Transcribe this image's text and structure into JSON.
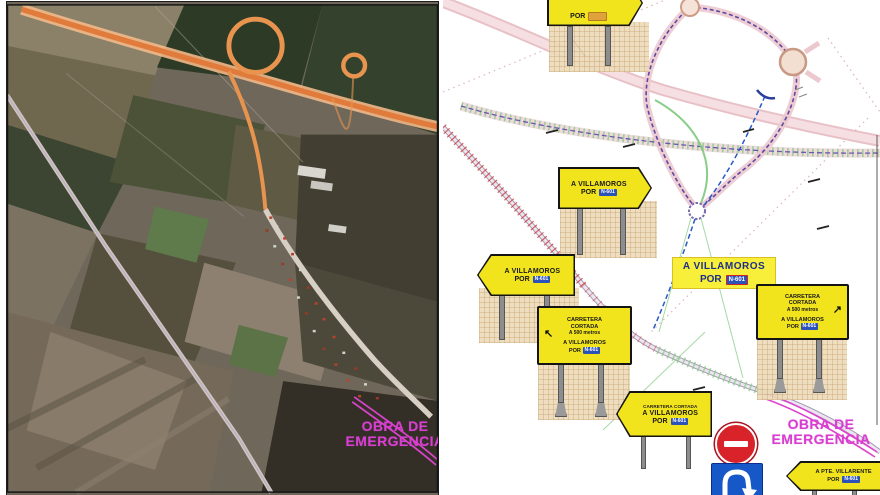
{
  "colors": {
    "sign_yellow": "#f2e41c",
    "badge_blue": "#2a52b8",
    "badge_orange": "#e0a33c",
    "badge_red_border": "#cc2222",
    "magenta_overlay": "#d83fd0",
    "no_entry_red": "#d8232a",
    "mandatory_blue": "#1758c8",
    "plan_highway_pink": "#e4b6bd",
    "plan_loop_purple": "#5b4a9e",
    "plan_works_green": "#8fca8f",
    "detour_blue_dashed": "#2858c8"
  },
  "left_panel": {
    "overlay": {
      "line1": "OBRA DE",
      "line2": "EMERGENCIA"
    }
  },
  "right_panel": {
    "overlay": {
      "line1": "OBRA DE",
      "line2": "EMERGENCIA"
    },
    "highlight_label": {
      "line1": "A VILLAMOROS",
      "line2": "POR",
      "badge": "N-601"
    },
    "signs": {
      "top": {
        "por": "POR",
        "badge": ""
      },
      "villamoros_right": {
        "line1": "A VILLAMOROS",
        "line2": "POR",
        "badge": "N-601"
      },
      "villamoros_left": {
        "line1": "A VILLAMOROS",
        "line2": "POR",
        "badge": "N-601"
      },
      "cortada_panel_left": {
        "line1": "CARRETERA",
        "line2": "CORTADA",
        "line3": "A 500 metros",
        "arrow": "↖",
        "line4": "A VILLAMOROS",
        "line5": "POR",
        "badge": "N-601"
      },
      "cortada_panel_right": {
        "line1": "CARRETERA",
        "line2": "CORTADA",
        "line3": "A 500 metros",
        "arrow": "↗",
        "line4": "A VILLAMOROS",
        "line5": "POR",
        "badge": "N-601"
      },
      "cortada_arrow": {
        "line1": "CARRETERA CORTADA",
        "line2": "A VILLAMOROS",
        "line3": "POR",
        "badge": "N-601"
      },
      "villarente": {
        "line1": "A PTE. VILLARENTE",
        "line2": "POR",
        "badge": "N-601"
      }
    }
  }
}
